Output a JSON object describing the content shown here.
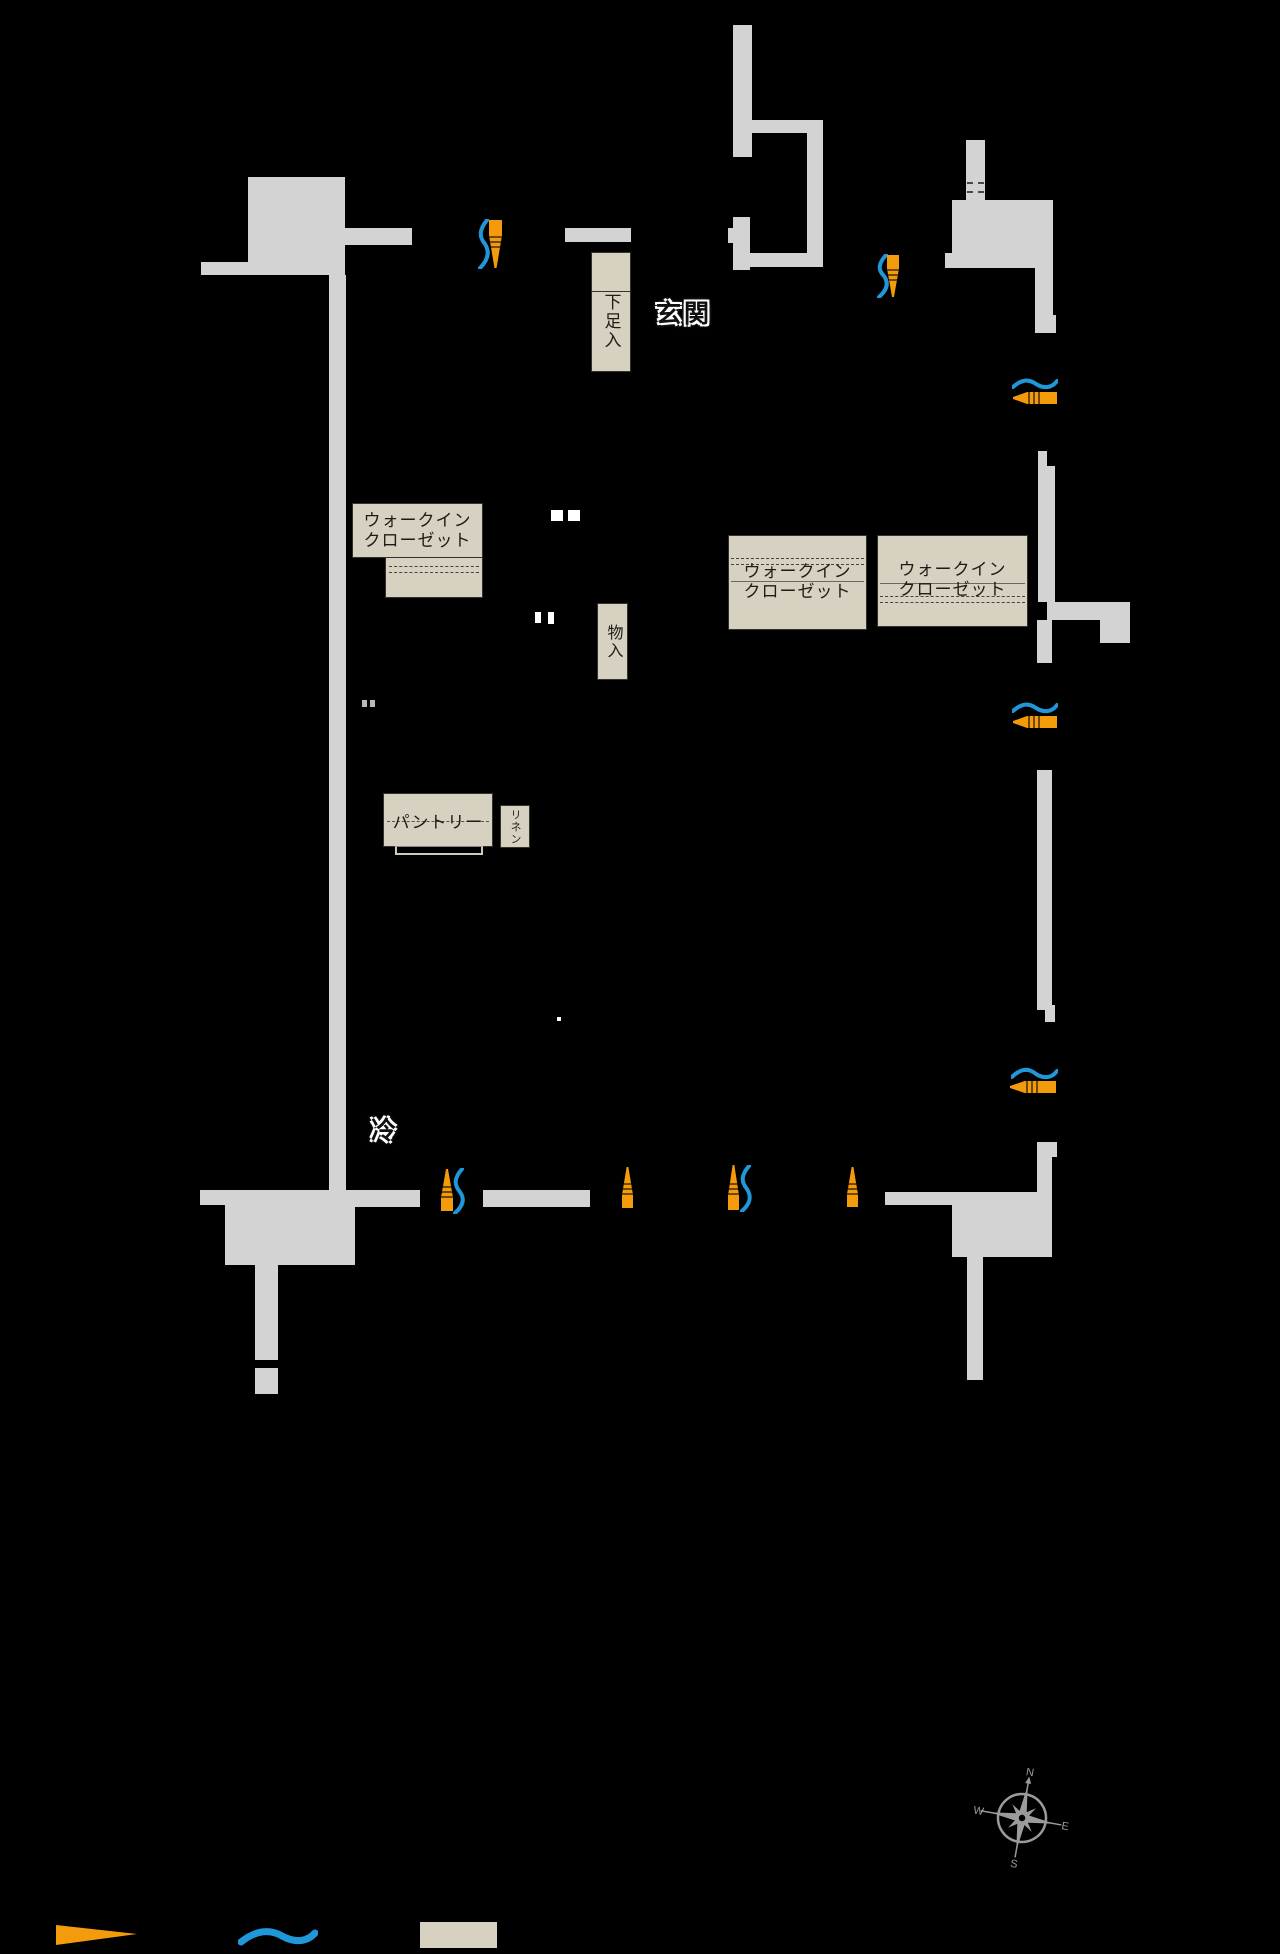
{
  "floorplan": {
    "labels": {
      "genkan": "玄関",
      "shoe_cabinet": "下足入",
      "wic_line1": "ウォークイン",
      "wic_line2": "クローゼット",
      "storage": "物入",
      "pantry": "パントリー",
      "linen": "リネン",
      "refrigerator": "冷"
    },
    "compass": {
      "n": "N",
      "e": "E",
      "s": "S",
      "w": "W"
    },
    "colors": {
      "background": "#000000",
      "wall": "#d3d3d3",
      "room-fill": "#d7d1c1",
      "room-border": "#34322b",
      "door-orange": "#f49b0c",
      "swing-blue": "#2097d8",
      "compass-gray": "#9b9b9b",
      "label-text": "#111111",
      "label-halo": "#ffffff"
    },
    "legend": {
      "door_symbol": "door-leaf",
      "swing_symbol": "swing-arc",
      "storage_symbol": "storage-box"
    }
  }
}
